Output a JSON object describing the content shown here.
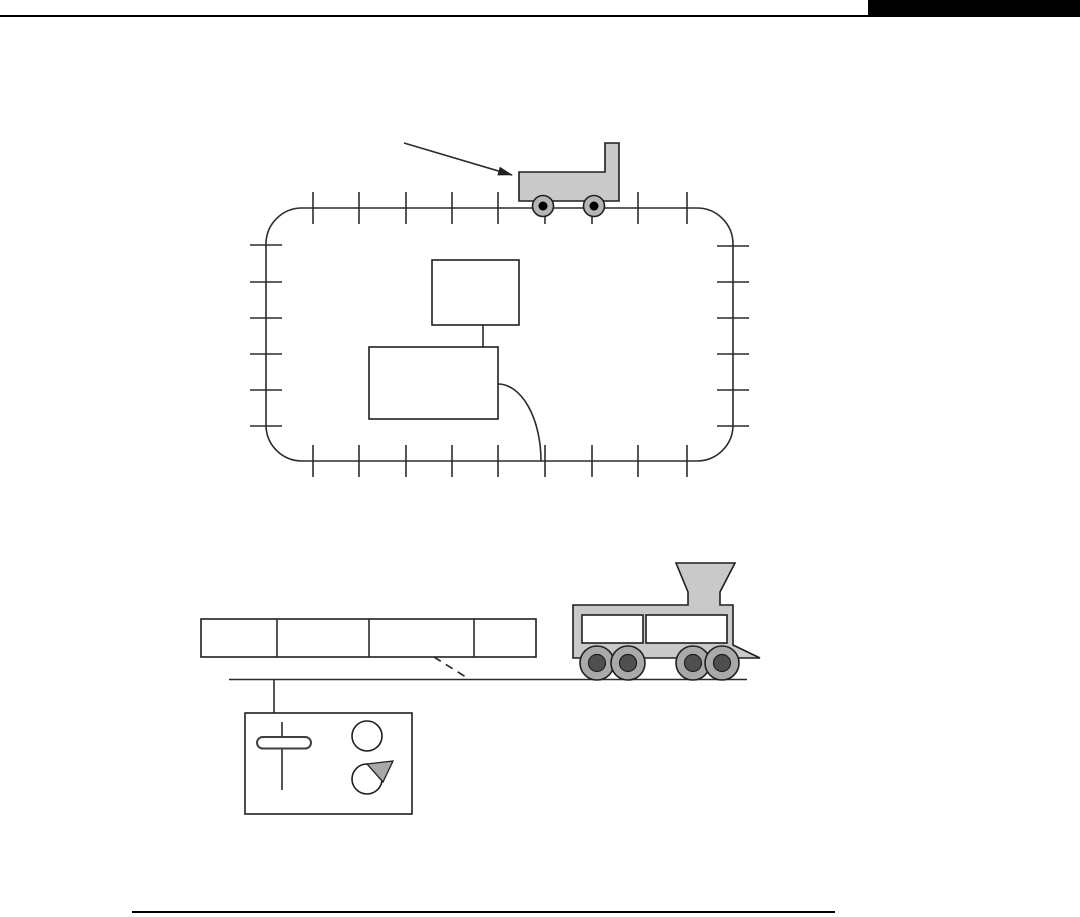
{
  "page": {
    "background": "#ffffff",
    "header": {
      "tab_color": "#000000",
      "rule_color": "#000000"
    },
    "footer": {
      "rule_color": "#000000"
    }
  },
  "colors": {
    "line": "#2b2b2b",
    "body_fill": "#c9c9c9",
    "box_fill": "#ffffff",
    "wagon_wheel_rim": "#b5b5b5",
    "wagon_wheel_hub": "#000000",
    "loco_wheel_rim": "#a9a9a9",
    "loco_wheel_hub": "#4f4f4f",
    "pointer_fill": "#a9a9a9"
  },
  "figures": {
    "oval_track": {
      "ticks_top_x": [
        313,
        359,
        406,
        452,
        498,
        545,
        592,
        638,
        687
      ],
      "ticks_bottom_x": [
        313,
        359,
        406,
        452,
        498,
        545,
        592,
        638,
        687
      ],
      "ticks_left_y": [
        245,
        282,
        318,
        354,
        390,
        426
      ],
      "ticks_right_y": [
        246,
        282,
        318,
        354,
        390,
        426
      ]
    },
    "wagon": {
      "wheels_x": [
        543,
        594
      ],
      "wheel_cy": 206,
      "wheel_r": 10.5,
      "hub_r": 4.5
    },
    "message_frame": {
      "dividers_x": [
        277,
        369,
        474
      ],
      "field_count": 4
    },
    "locomotive": {
      "wheels_x": [
        597,
        628,
        693,
        722
      ],
      "wheel_cy": 663,
      "wheel_r": 17,
      "hub_r": 8.5
    }
  }
}
